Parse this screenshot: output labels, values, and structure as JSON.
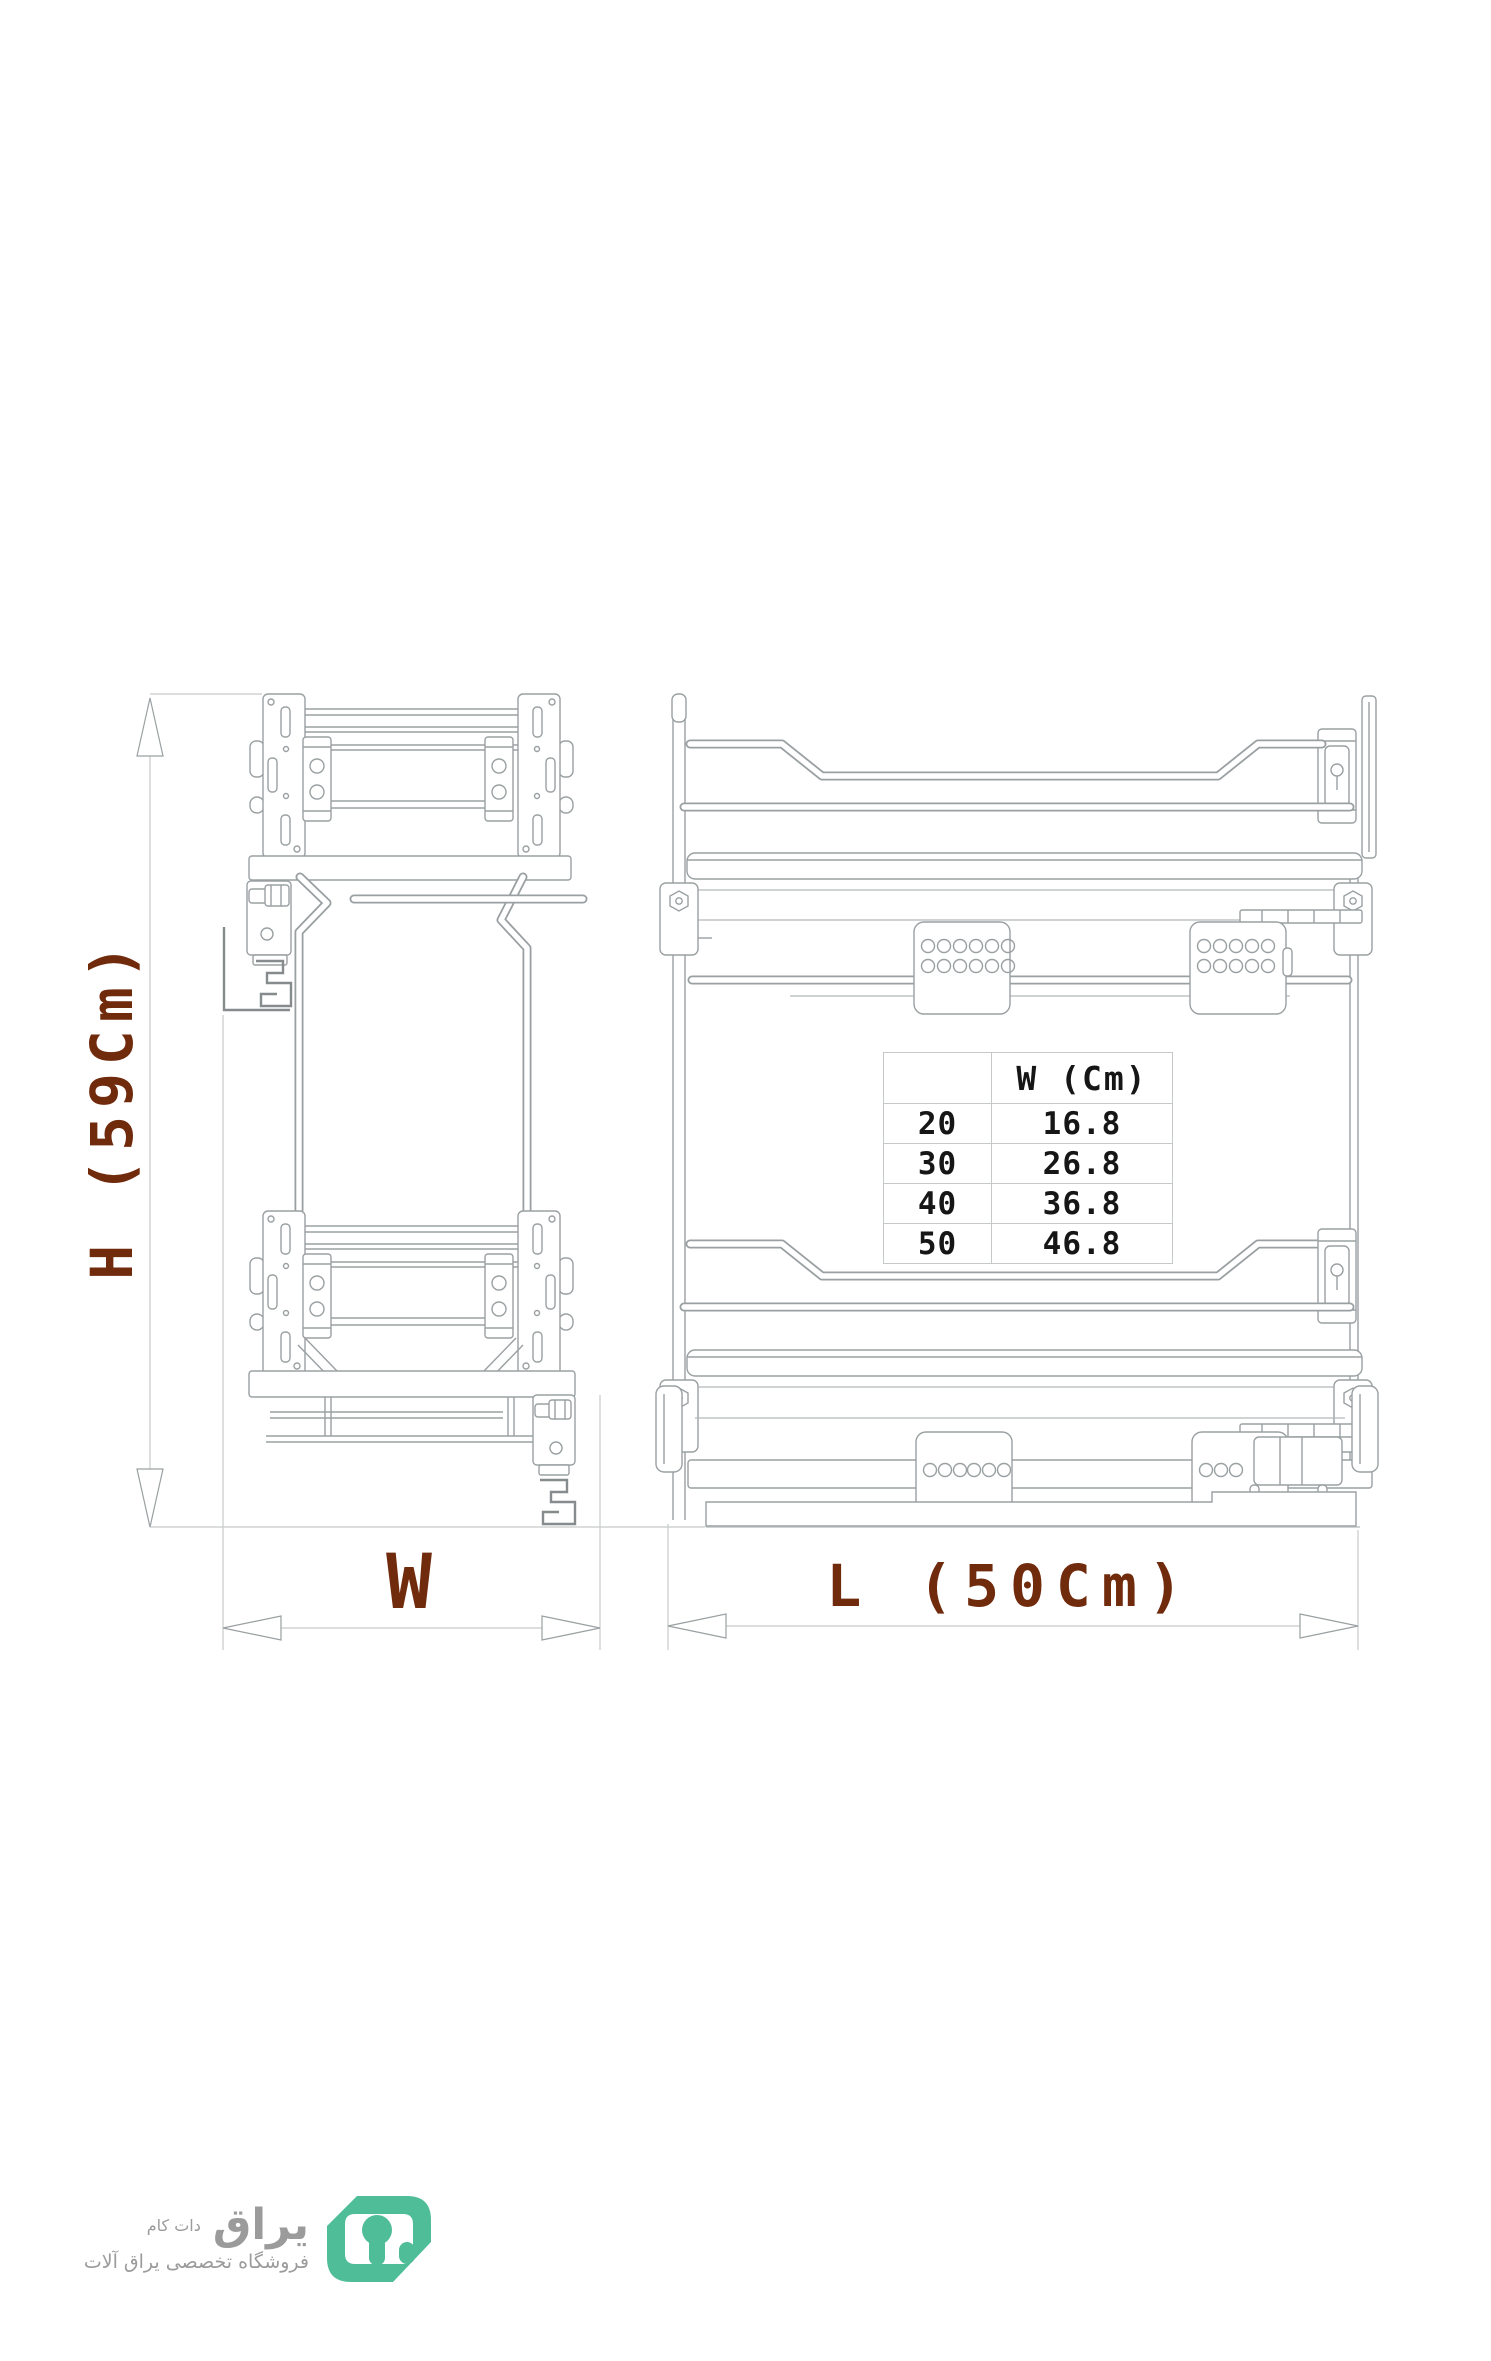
{
  "page": {
    "background": "#ffffff"
  },
  "drawing": {
    "subject": "pull-out cabinet wire basket - technical drawing, front and side elevations",
    "views": [
      {
        "id": "front-view",
        "description": "narrow front elevation with mounting plates and slide rail"
      },
      {
        "id": "side-view",
        "description": "wide side elevation with two basket tiers and slide"
      }
    ],
    "line_color": "#9aa0a2"
  },
  "dimensions": {
    "height": {
      "label": "H (59Cm)"
    },
    "width": {
      "label": "W"
    },
    "length": {
      "label": "L (50Cm)"
    },
    "label_color": "#702a0c"
  },
  "size_table": {
    "header": {
      "col1": "",
      "col2": "W (Cm)"
    },
    "rows": [
      {
        "size": "20",
        "w": "16.8"
      },
      {
        "size": "30",
        "w": "26.8"
      },
      {
        "size": "40",
        "w": "36.8"
      },
      {
        "size": "50",
        "w": "46.8"
      }
    ]
  },
  "logo": {
    "brand": "یراق",
    "suffix": "دات کام",
    "tagline": "فروشگاه تخصصی یراق آلات",
    "icon": "keyhole-logo-icon",
    "icon_color": "#4ebd98",
    "text_color": "#9b9b9b"
  }
}
